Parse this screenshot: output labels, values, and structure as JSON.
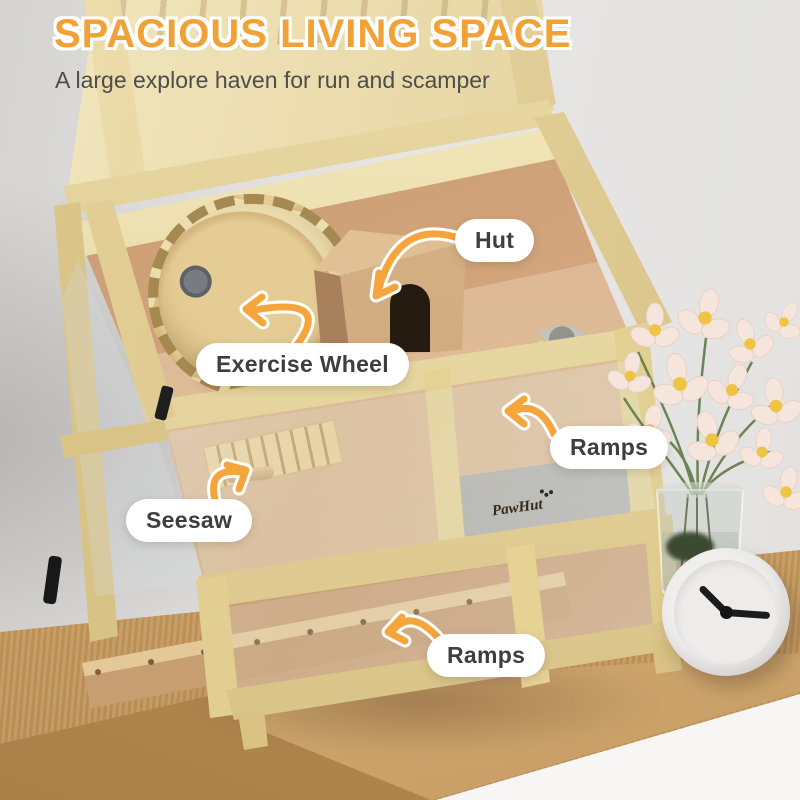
{
  "header": {
    "title": "SPACIOUS LIVING SPACE",
    "subtitle": "A large explore haven for run and scamper"
  },
  "callouts": {
    "hut": {
      "label": "Hut"
    },
    "exercise_wheel": {
      "label": "Exercise Wheel"
    },
    "ramps_upper": {
      "label": "Ramps"
    },
    "seesaw": {
      "label": "Seesaw"
    },
    "ramps_lower": {
      "label": "Ramps"
    }
  },
  "product": {
    "brand": "PawHut"
  },
  "scene": {
    "objects": [
      "wooden hamster cage with open lid",
      "exercise wheel",
      "wooden hut",
      "two ramps",
      "seesaw",
      "food bowl",
      "cosmos flowers in glass vase",
      "white desk clock",
      "oak cabinet"
    ],
    "clock_time_approx": "10:15"
  },
  "colors": {
    "title_orange": "#F2A136",
    "arrow_orange": "#F5A53B",
    "label_text": "#3E3E3E",
    "wood_frame": "#E7D49B",
    "interior_wood": "#CDA17B",
    "table_wood": "#C9A368",
    "wall_gray": "#E6E5E2",
    "flower_petal": "#F6E4DC",
    "flower_center": "#EFC343",
    "leaf_green": "#5E7A45"
  }
}
